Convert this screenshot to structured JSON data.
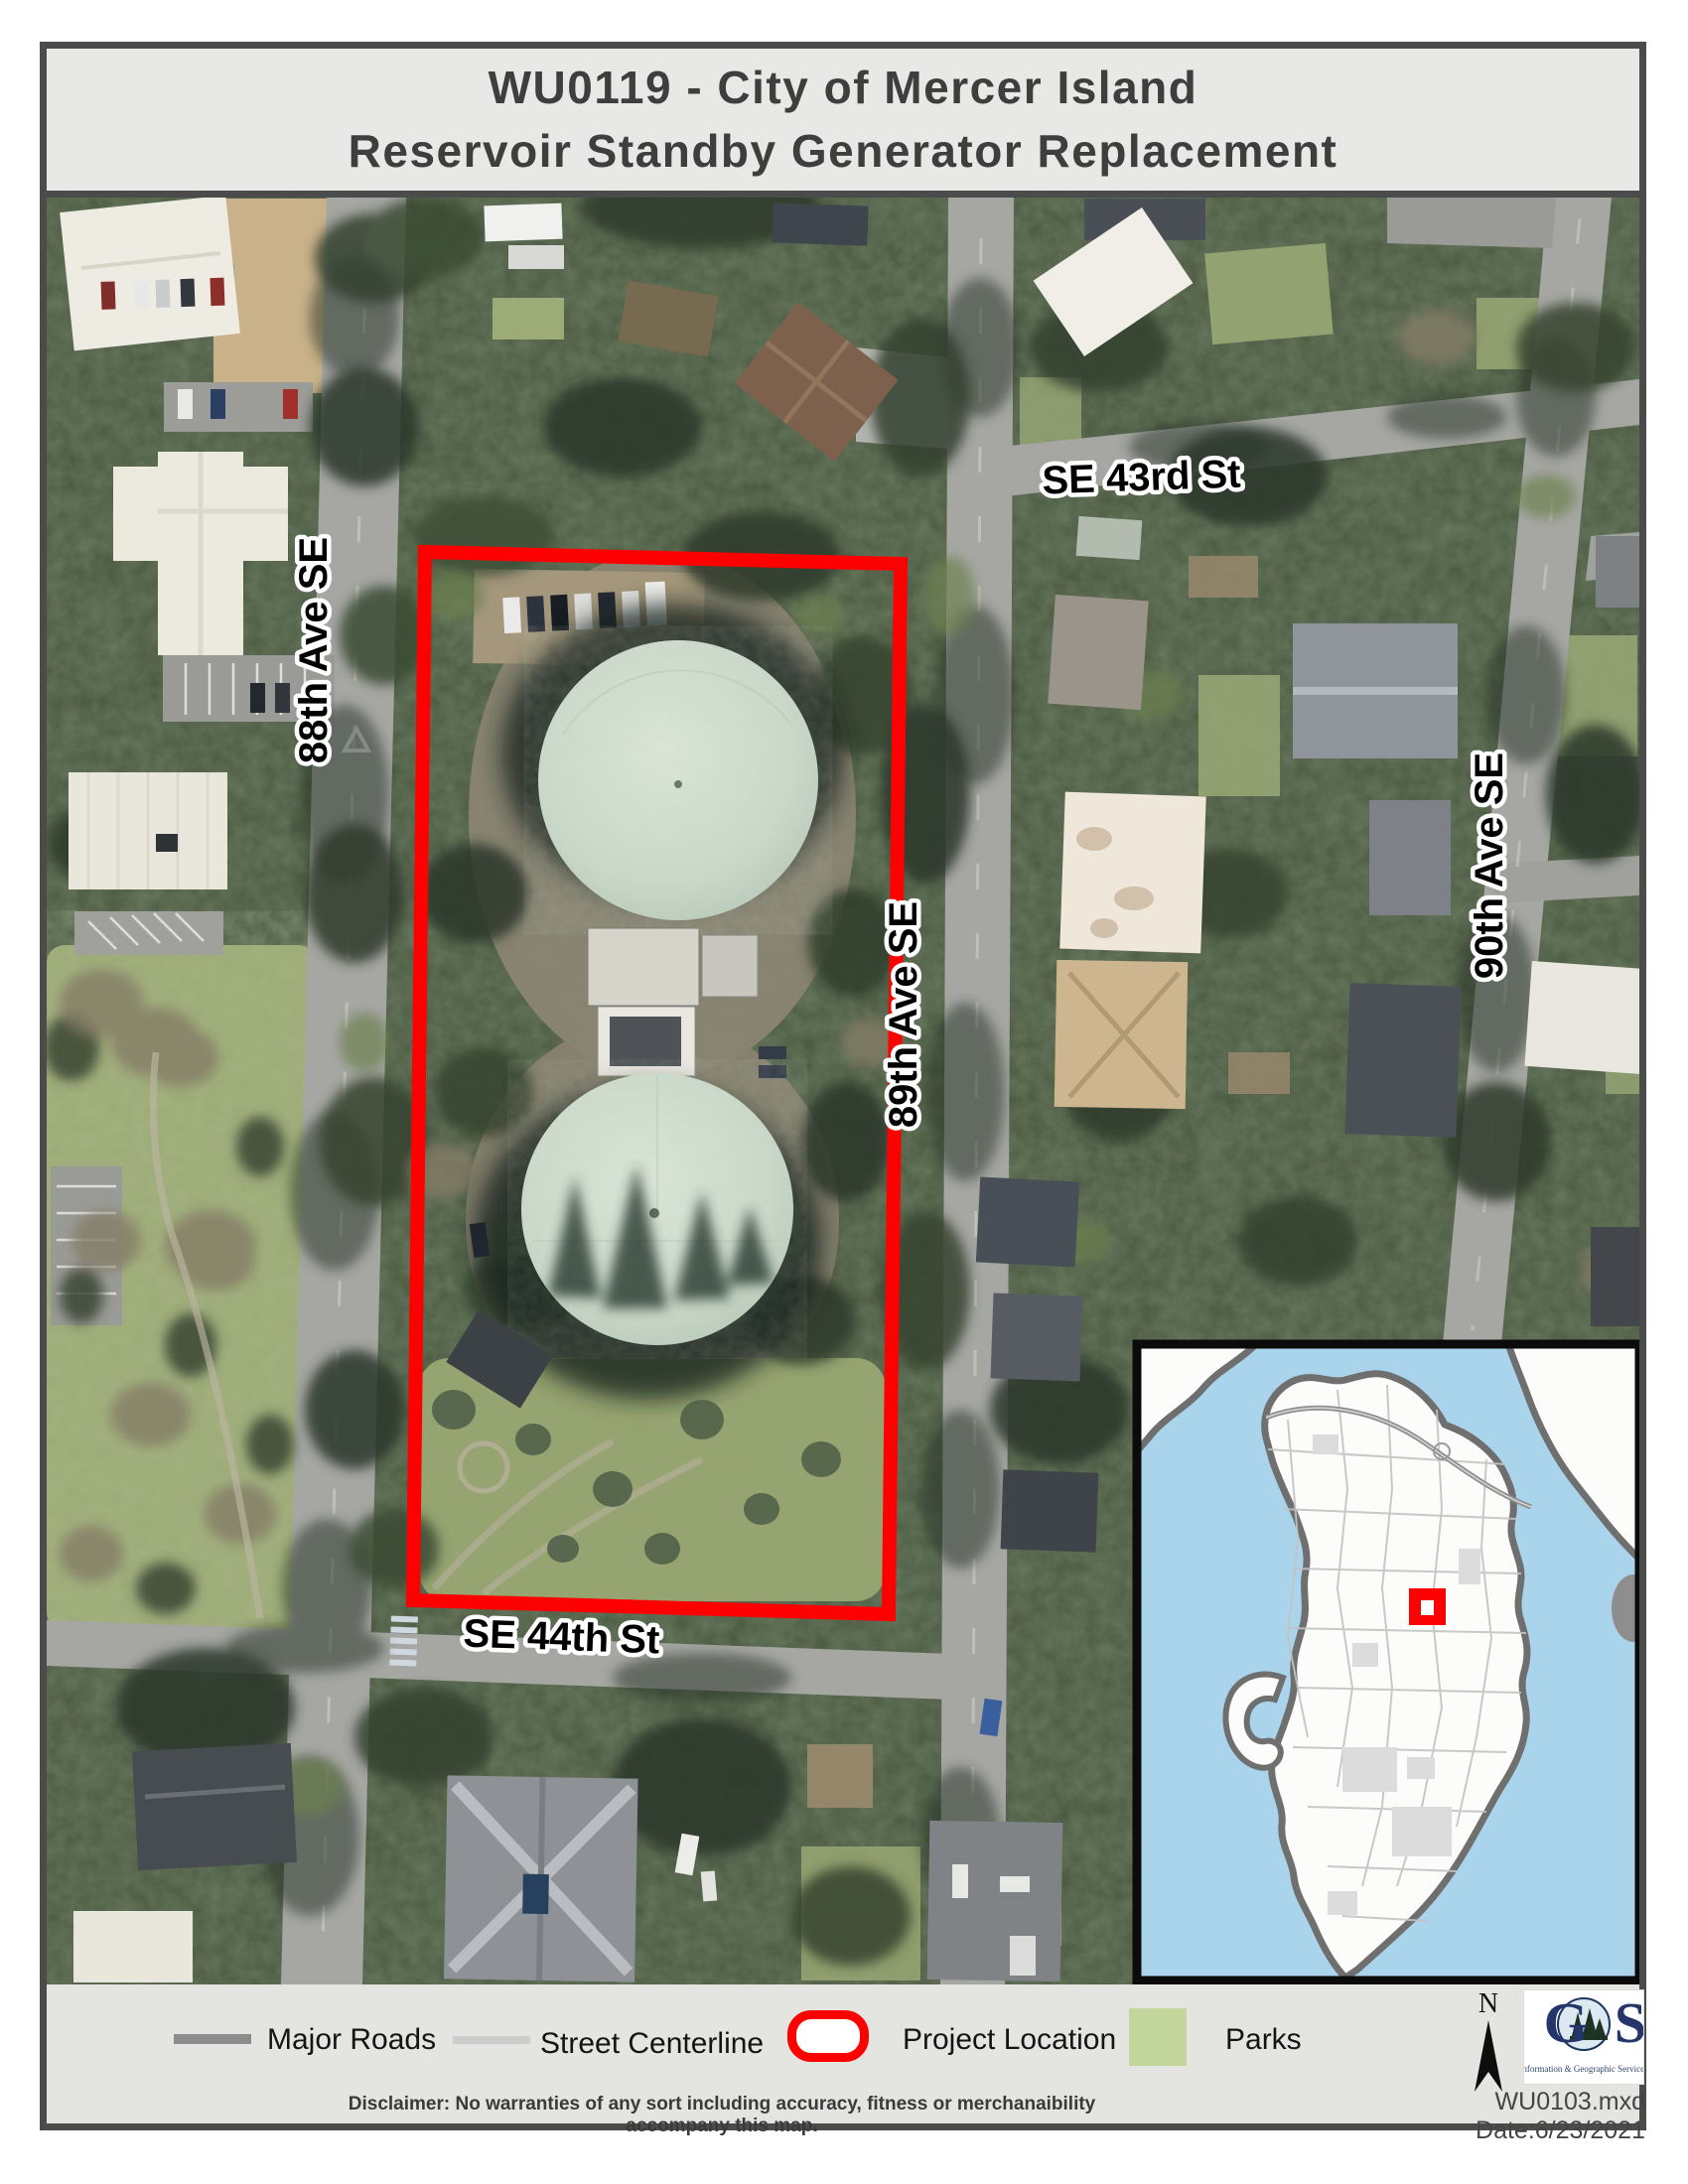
{
  "title": {
    "line1": "WU0119 - City of Mercer Island",
    "line2": "Reservoir Standby Generator Replacement"
  },
  "map": {
    "streets": {
      "se43rd": "SE 43rd St",
      "ave88": "88th Ave SE",
      "ave89": "89th Ave SE",
      "ave90": "90th Ave SE",
      "se44th": "SE 44th St"
    }
  },
  "legend": {
    "major_roads": "Major Roads",
    "street_centerline": "Street Centerline",
    "project_location": "Project Location",
    "parks": "Parks"
  },
  "compass": {
    "north_label": "N"
  },
  "logo": {
    "acronym": "IGS",
    "caption": "Information & Geographic Services"
  },
  "footer": {
    "disclaimer": "Disclaimer: No warranties of any sort including accuracy, fitness or merchanaibility accompany this map.",
    "file_text": "WU0103.mxd Date:6/23/2021"
  },
  "colors": {
    "project_boundary": "#FE0000",
    "parks_swatch": "#C3D69B",
    "major_road_swatch": "#8C8C8C",
    "street_centerline_swatch": "#CDCDCD",
    "inset_water": "#AAD4EC",
    "inset_marker": "#FD0000"
  }
}
